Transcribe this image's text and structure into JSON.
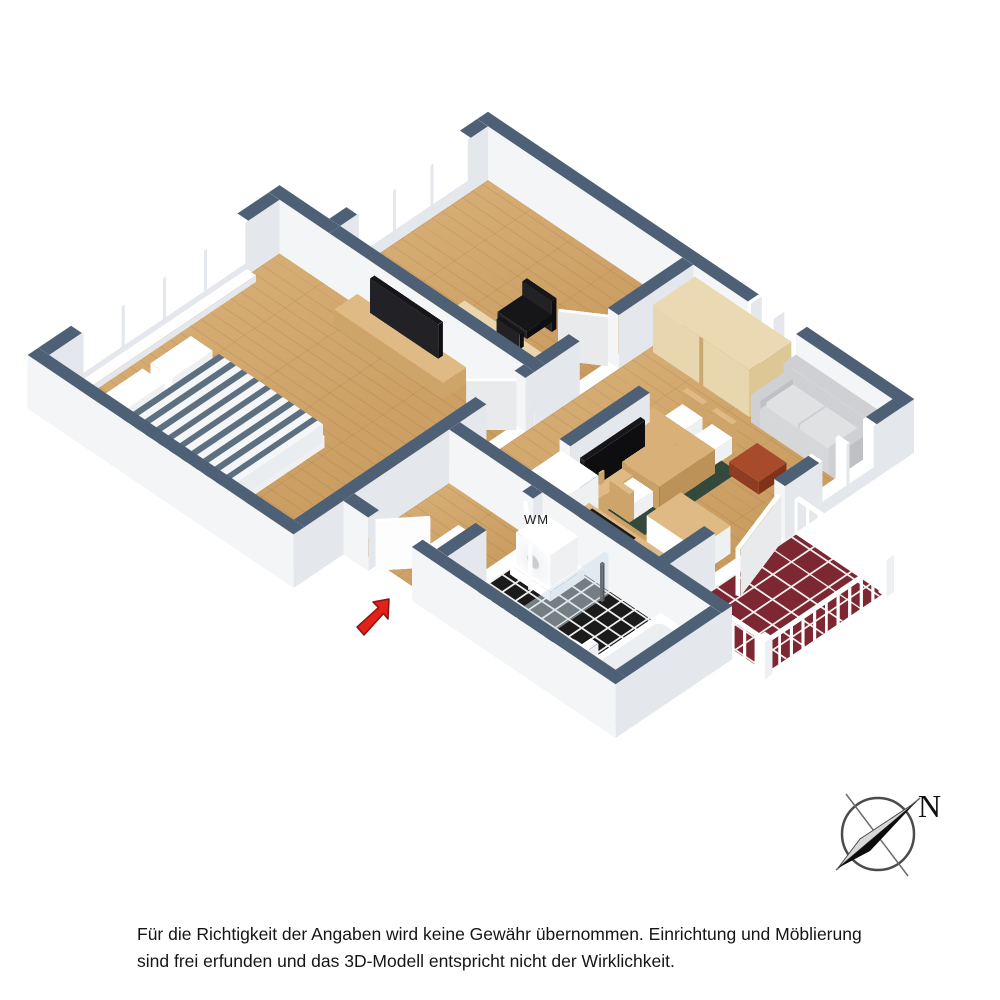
{
  "annotations": {
    "washing_machine_label": "WM",
    "compass_north_label": "N",
    "disclaimer_line1": "Für die Richtigkeit der Angaben wird keine Gewähr übernommen. Einrichtung und Möblierung",
    "disclaimer_line2": "sind frei erfunden und das 3D-Modell entspricht nicht der Wirklichkeit."
  },
  "colors": {
    "slate": "#4e6076",
    "wall_face": "#f4f5f6",
    "wall_side": "#e4e7eb",
    "wood_floor_light": "#d6ad74",
    "wood_floor_dark": "#c89a5e",
    "grout": "#efefef",
    "tile_black": "#1b1b1c",
    "balcony_red": "#7c2731",
    "rug_green": "#32493b",
    "furn_wood_top": "#e0ba84",
    "furn_wood_side": "#cda469",
    "birch_top": "#ead9b2",
    "birch_side": "#dcc795",
    "sofa_gray": "#d6d7d9",
    "sofa_light": "#e0e1e3",
    "tv_black": "#161618",
    "table_red": "#a84b2a",
    "bed_stripe": "#5d7082",
    "arrow_red": "#e32119",
    "glass": "rgba(205,224,233,0.5)",
    "white": "#ffffff"
  }
}
